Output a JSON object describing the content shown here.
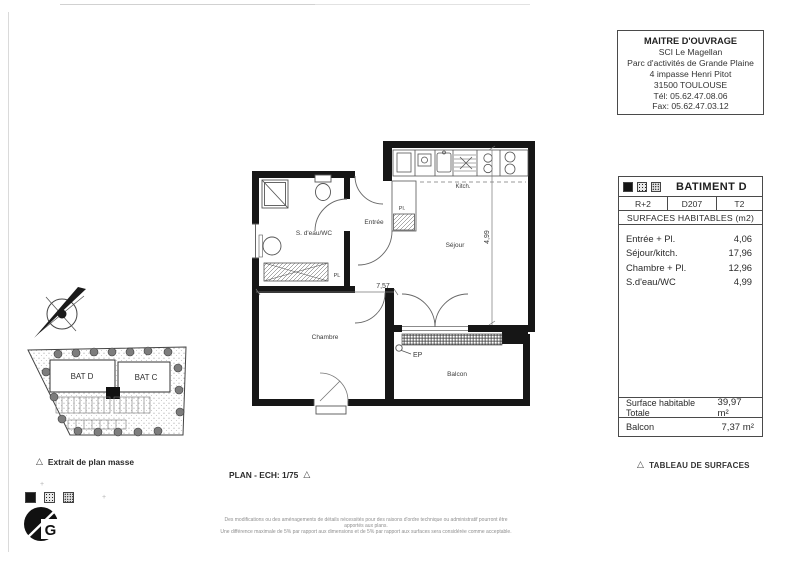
{
  "title_block": {
    "lines": [
      "MAITRE D'OUVRAGE",
      "SCI Le Magellan",
      "Parc d'activités de Grande Plaine",
      "4 impasse Henri Pitot",
      "31500 TOULOUSE",
      "Tél: 05.62.47.08.06",
      "Fax: 05.62.47.03.12"
    ]
  },
  "surfaces_table": {
    "building_label": "BATIMENT D",
    "level": "R+2",
    "lot": "D207",
    "type": "T2",
    "section_title": "SURFACES HABITABLES (m2)",
    "rows": [
      {
        "label": "Entrée + Pl.",
        "value": "4,06"
      },
      {
        "label": "Séjour/kitch.",
        "value": "17,96"
      },
      {
        "label": "Chambre + Pl.",
        "value": "12,96"
      },
      {
        "label": "S.d'eau/WC",
        "value": "4,99"
      }
    ],
    "total": {
      "label": "Surface habitable Totale",
      "value": "39,97 m²"
    },
    "balcony": {
      "label": "Balcon",
      "value": "7,37 m²"
    }
  },
  "floor_plan": {
    "labels": {
      "bathroom": "S. d'eau/WC",
      "entrance": "Entrée",
      "kitchen": "Kitch.",
      "living": "Séjour",
      "bedroom": "Chambre",
      "balcony": "Balcon",
      "closet_small": "Pl.",
      "closet_large": "PL",
      "drain": "EP"
    },
    "dimensions": {
      "living_height": "4,99",
      "width": "7,57"
    }
  },
  "site_plan": {
    "building_d": "BAT D",
    "building_c": "BAT C",
    "caption": "Extrait de plan masse"
  },
  "footer": {
    "scale_label": "PLAN - ECH: 1/75",
    "table_caption": "TABLEAU DE SURFACES",
    "disclaimer_line1": "Des modifications ou des aménagements de détails nécessités pour des raisons d'ordre technique ou administratif pourront être apportés aux plans.",
    "disclaimer_line2": "Une différence maximale de 5% par rapport aux dimensions et de 5% par rapport aux surfaces sera considérée comme acceptable."
  }
}
